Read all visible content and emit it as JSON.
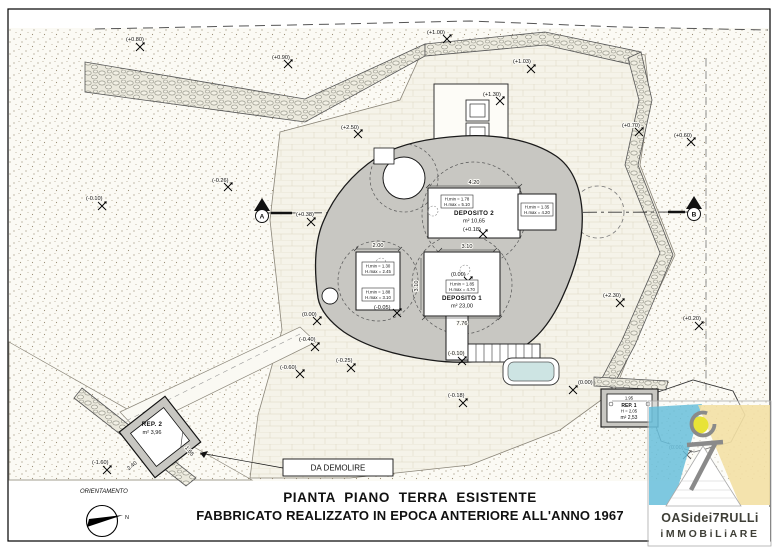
{
  "sheet": {
    "title_line1": "PIANTA  PIANO  TERRA  ESISTENTE",
    "title_line2": "FABBRICATO REALIZZATO IN EPOCA ANTERIORE ALL'ANNO 1967"
  },
  "orientation": {
    "label": "ORIENTAMENTO",
    "north_label": "N"
  },
  "section_markers": {
    "a": "A",
    "b": "B"
  },
  "well": {
    "level": "(+1.30)"
  },
  "rooms": {
    "deposito2": {
      "name": "DEPOSITO 2",
      "area": "m² 10,65",
      "level": "(+0.18)",
      "width_dim": "4.20",
      "hbox_l1": "H.min = 1.78",
      "hbox_l2": "H.max = 5.10",
      "hbox2_l1": "H.min = 1.35",
      "hbox2_l2": "H.max = 4.20"
    },
    "deposito1": {
      "name": "DEPOSITO 1",
      "area": "m² 23,00",
      "level": "(0.00)",
      "top_dim": "3.10",
      "side_dim": "3.10",
      "bottom_dim": "7.76",
      "hbox_l1": "H.min = 1.85",
      "hbox_l2": "H.max = 4.70"
    },
    "storage_left": {
      "top_dim": "2.00",
      "level": "(-0.05)",
      "hbox_a_l1": "H.min = 1.30",
      "hbox_a_l2": "H.max = 2.45",
      "hbox_b_l1": "H.min = 1.88",
      "hbox_b_l2": "H.max = 3.10"
    }
  },
  "outbuildings": {
    "rep2": {
      "name": "REP. 2",
      "area": "m² 3,96",
      "dim_a": "2.40",
      "dim_b": "1.65"
    },
    "rep1": {
      "name": "REP. 1",
      "height": "H = 2,05",
      "area": "m² 2,53",
      "dim": "1.95"
    },
    "demolition_note": "DA DEMOLIRE"
  },
  "spots": [
    {
      "t": "(+0.80)"
    },
    {
      "t": "(+0.90)"
    },
    {
      "t": "(+1.00)"
    },
    {
      "t": "(+1.03)"
    },
    {
      "t": "(+2.50)"
    },
    {
      "t": "(+0.70)"
    },
    {
      "t": "(+0.60)"
    },
    {
      "t": "(-0.26)"
    },
    {
      "t": "(-0.10)"
    },
    {
      "t": "(+0.38)"
    },
    {
      "t": "(+2.30)"
    },
    {
      "t": "(+0.20)"
    },
    {
      "t": "(0.00)"
    },
    {
      "t": "(-0.40)"
    },
    {
      "t": "(-0.60)"
    },
    {
      "t": "(-0.25)"
    },
    {
      "t": "(-0.10)"
    },
    {
      "t": "(-0.18)"
    },
    {
      "t": "(0.00)"
    },
    {
      "t": "(0.00)"
    },
    {
      "t": "(-1.60)"
    }
  ],
  "logo": {
    "line1": "OASidei7RULLi",
    "line2": "iMMOBiLiARE"
  },
  "colors": {
    "building_fill": "#c8c7c2",
    "stone_fill": "#eae8dc",
    "basin_fill": "#cde4e3",
    "logo_blue": "#62bcd9",
    "logo_tan": "#f3dfa2",
    "logo_yellow": "#e8e337"
  }
}
